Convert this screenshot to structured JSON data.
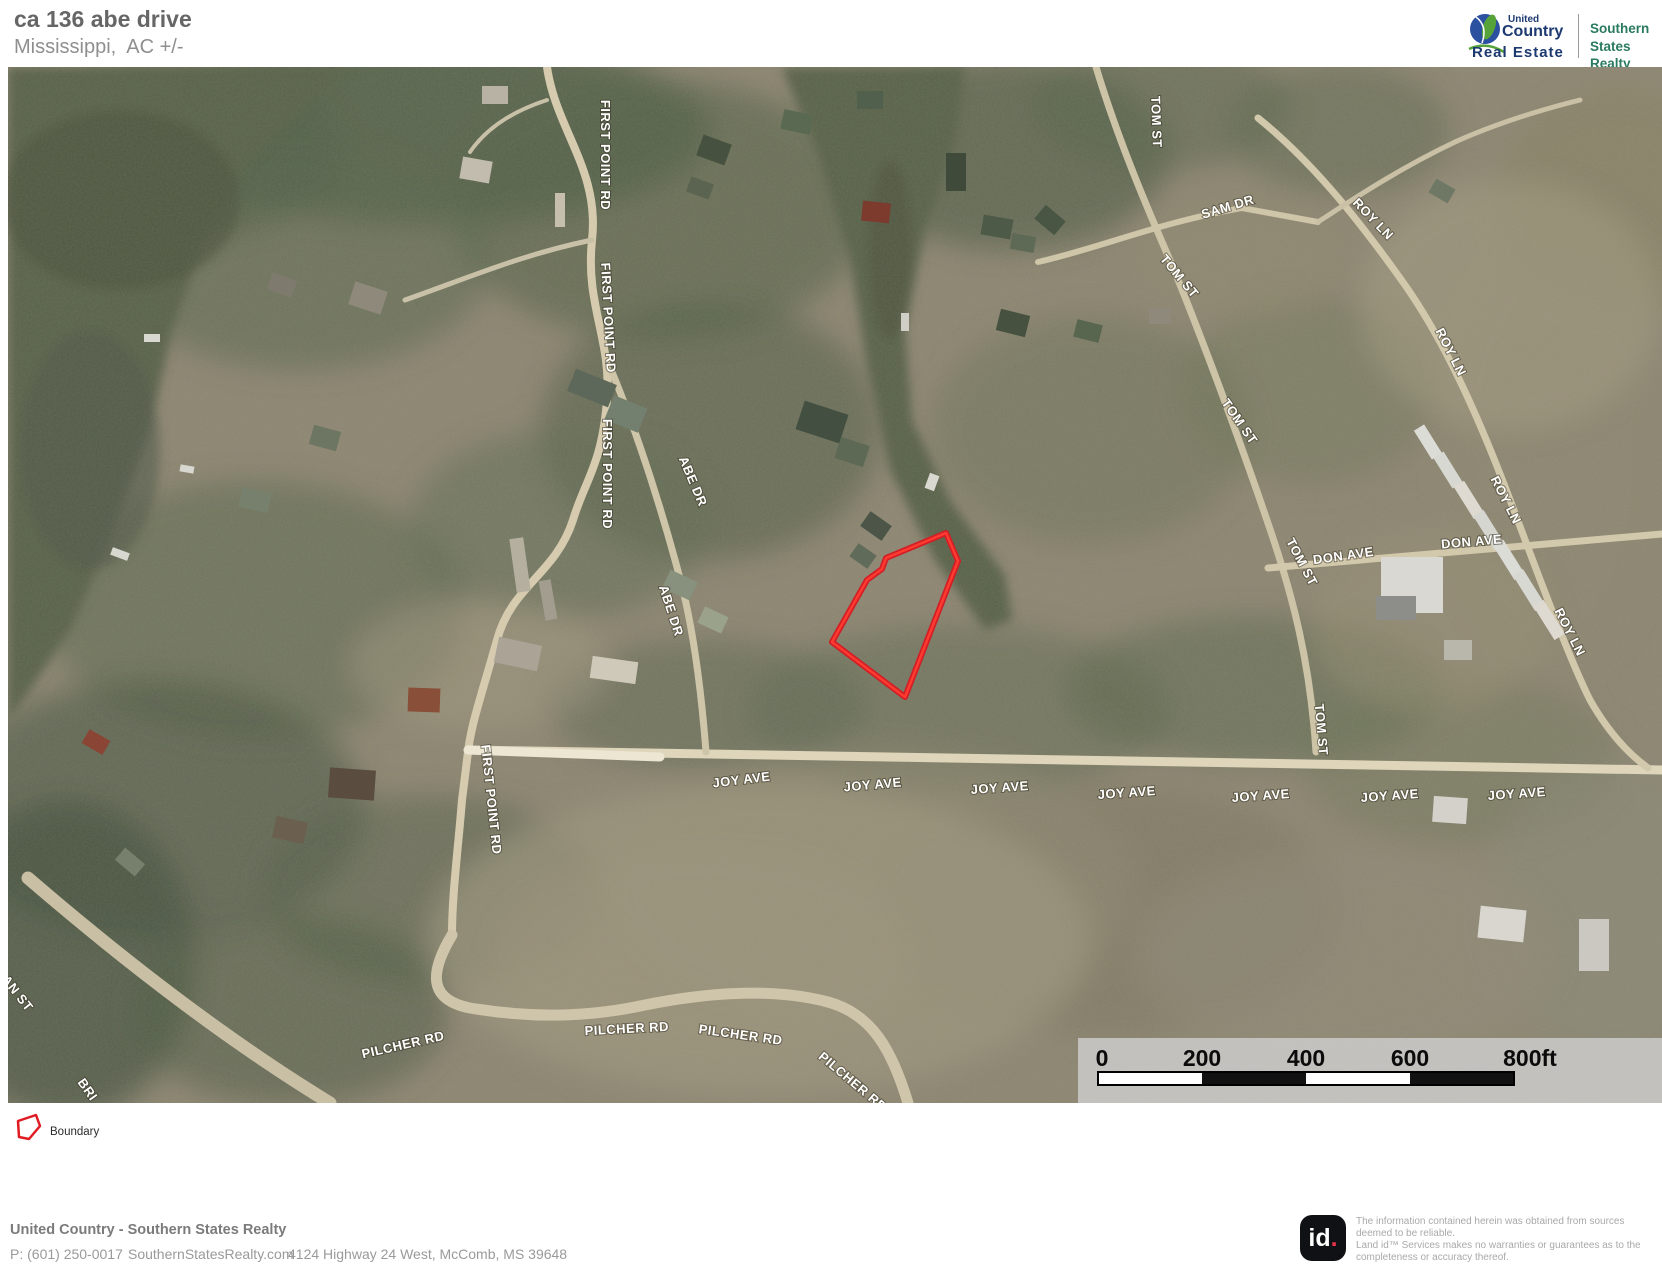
{
  "header": {
    "title": "ca 136 abe drive",
    "subtitle": "Mississippi,  AC +/-"
  },
  "brand": {
    "uc_top": "United",
    "uc_bottom": "Country",
    "uc_tagline": "Real Estate",
    "partner_top": "Southern",
    "partner_bottom": "States Realty"
  },
  "map": {
    "street_labels": [
      {
        "text": "FIRST POINT RD",
        "x": 601,
        "y": 155,
        "rot": 90
      },
      {
        "text": "FIRST POINT RD",
        "x": 604,
        "y": 318,
        "rot": 87
      },
      {
        "text": "FIRST POINT RD",
        "x": 603,
        "y": 474,
        "rot": 90
      },
      {
        "text": "FIRST POINT RD",
        "x": 487,
        "y": 800,
        "rot": 84
      },
      {
        "text": "ABE DR",
        "x": 689,
        "y": 483,
        "rot": 67
      },
      {
        "text": "ABE DR",
        "x": 667,
        "y": 612,
        "rot": 72
      },
      {
        "text": "TOM ST",
        "x": 1152,
        "y": 122,
        "rot": 88
      },
      {
        "text": "TOM ST",
        "x": 1176,
        "y": 279,
        "rot": 50
      },
      {
        "text": "TOM ST",
        "x": 1236,
        "y": 424,
        "rot": 55
      },
      {
        "text": "TOM ST",
        "x": 1298,
        "y": 564,
        "rot": 62
      },
      {
        "text": "TOM ST",
        "x": 1317,
        "y": 730,
        "rot": 85
      },
      {
        "text": "SAM DR",
        "x": 1229,
        "y": 211,
        "rot": -17
      },
      {
        "text": "ROY LN",
        "x": 1370,
        "y": 222,
        "rot": 46
      },
      {
        "text": "ROY LN",
        "x": 1447,
        "y": 354,
        "rot": 63
      },
      {
        "text": "ROY LN",
        "x": 1502,
        "y": 502,
        "rot": 63
      },
      {
        "text": "ROY LN",
        "x": 1566,
        "y": 634,
        "rot": 63
      },
      {
        "text": "DON AVE",
        "x": 1344,
        "y": 560,
        "rot": -8
      },
      {
        "text": "DON AVE",
        "x": 1472,
        "y": 546,
        "rot": -5
      },
      {
        "text": "JOY AVE",
        "x": 742,
        "y": 784,
        "rot": -7
      },
      {
        "text": "JOY AVE",
        "x": 873,
        "y": 789,
        "rot": -5
      },
      {
        "text": "JOY AVE",
        "x": 1000,
        "y": 792,
        "rot": -4
      },
      {
        "text": "JOY AVE",
        "x": 1127,
        "y": 797,
        "rot": -4
      },
      {
        "text": "JOY AVE",
        "x": 1261,
        "y": 800,
        "rot": -4
      },
      {
        "text": "JOY AVE",
        "x": 1390,
        "y": 800,
        "rot": -4
      },
      {
        "text": "JOY AVE",
        "x": 1517,
        "y": 798,
        "rot": -4
      },
      {
        "text": "PILCHER RD",
        "x": 404,
        "y": 1049,
        "rot": -13
      },
      {
        "text": "PILCHER RD",
        "x": 627,
        "y": 1033,
        "rot": -3
      },
      {
        "text": "PILCHER RD",
        "x": 740,
        "y": 1039,
        "rot": 8
      },
      {
        "text": "PILCHER RD",
        "x": 850,
        "y": 1085,
        "rot": 40
      },
      {
        "text": "AN ST",
        "x": 14,
        "y": 996,
        "rot": 52
      },
      {
        "text": "BRI",
        "x": 84,
        "y": 1092,
        "rot": 55
      }
    ],
    "scale_bar": {
      "tick_labels": [
        "0",
        "200",
        "400",
        "600",
        "800ft"
      ],
      "tick_x": [
        1102,
        1202,
        1306,
        1410,
        1530
      ]
    }
  },
  "legend": {
    "boundary_label": "Boundary"
  },
  "footer": {
    "company": "United Country - Southern States Realty",
    "phone": "P: (601) 250-0017",
    "website": "SouthernStatesRealty.com",
    "address": "4124 Highway 24 West, McComb, MS 39648"
  },
  "disclaimer": {
    "logo_id": "id",
    "logo_dot": ".",
    "text": "The information contained herein  was obtained from sources deemed to be reliable.\n Land id™ Services makes no  warranties or guarantees as to the completeness or accuracy thereof."
  },
  "colors": {
    "boundary_red": "#e11b22",
    "brand_navy": "#1d3a70",
    "brand_green": "#56a33a",
    "partner_teal": "#2a7a60"
  }
}
